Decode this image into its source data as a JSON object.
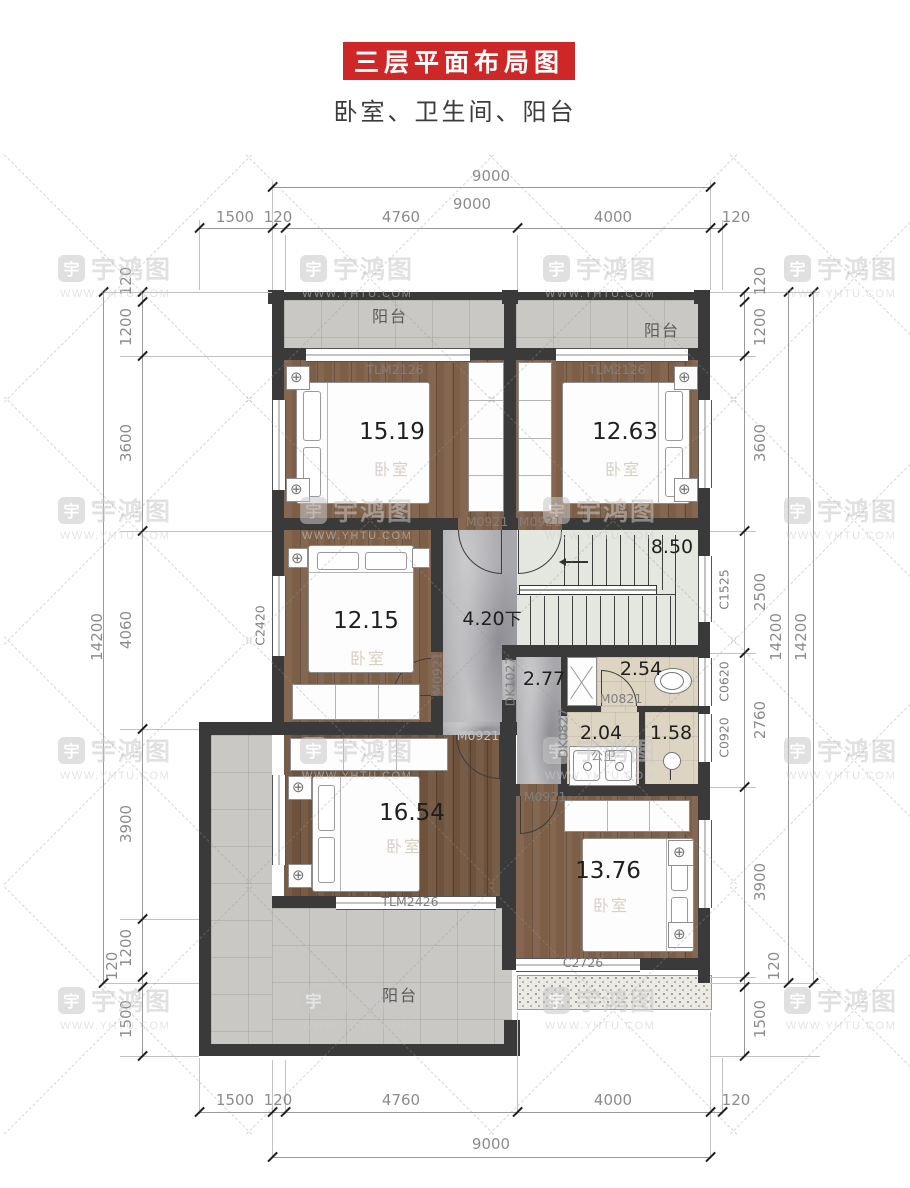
{
  "title": "三层平面布局图",
  "subtitle": "卧室、卫生间、阳台",
  "watermark": {
    "logo_char": "宇",
    "brand": "宇鸿图",
    "url": "WWW.YHTU.COM"
  },
  "icons": {
    "lamp": "⊕"
  },
  "dims": {
    "h_total": "9000",
    "h_segments": [
      "1500",
      "120",
      "4760",
      "4000",
      "120"
    ],
    "v_total": "14200",
    "v_left": [
      "120",
      "1200",
      "3600",
      "4060",
      "3900",
      "1200",
      "120",
      "1500"
    ],
    "v_right": [
      "120",
      "1200",
      "3600",
      "2500",
      "2760",
      "3900",
      "120",
      "1500"
    ]
  },
  "rooms": {
    "balcony_top_left": "阳台",
    "balcony_top_right": "阳台",
    "balcony_bottom": "阳台",
    "bedroom_top_left": {
      "area": "15.19",
      "name": "卧室"
    },
    "bedroom_top_right": {
      "area": "12.63",
      "name": "卧室"
    },
    "bedroom_mid_left": {
      "area": "12.15",
      "name": "卧室"
    },
    "bedroom_bottom_left": {
      "area": "16.54",
      "name": "卧室"
    },
    "bedroom_bottom_right": {
      "area": "13.76",
      "name": "卧室"
    },
    "hall": {
      "area": "4.20",
      "direction": "下"
    },
    "stairs": {
      "area": "8.50"
    },
    "corridor": {
      "area": "2.77"
    },
    "toilet": {
      "area": "2.54"
    },
    "bath": {
      "area": "2.04",
      "name": "公卫"
    },
    "shower": {
      "area": "1.58"
    }
  },
  "codes": {
    "tlm2126": "TLM2126",
    "tlm2426": "TLM2426",
    "m0921": "M0921",
    "m0821": "M0821",
    "dk1027": "DK1027",
    "dk0827": "DK0827",
    "c2420": "C2420",
    "c1525": "C1525",
    "c0620": "C0620",
    "c0920": "C0920",
    "c2726": "C2726"
  }
}
